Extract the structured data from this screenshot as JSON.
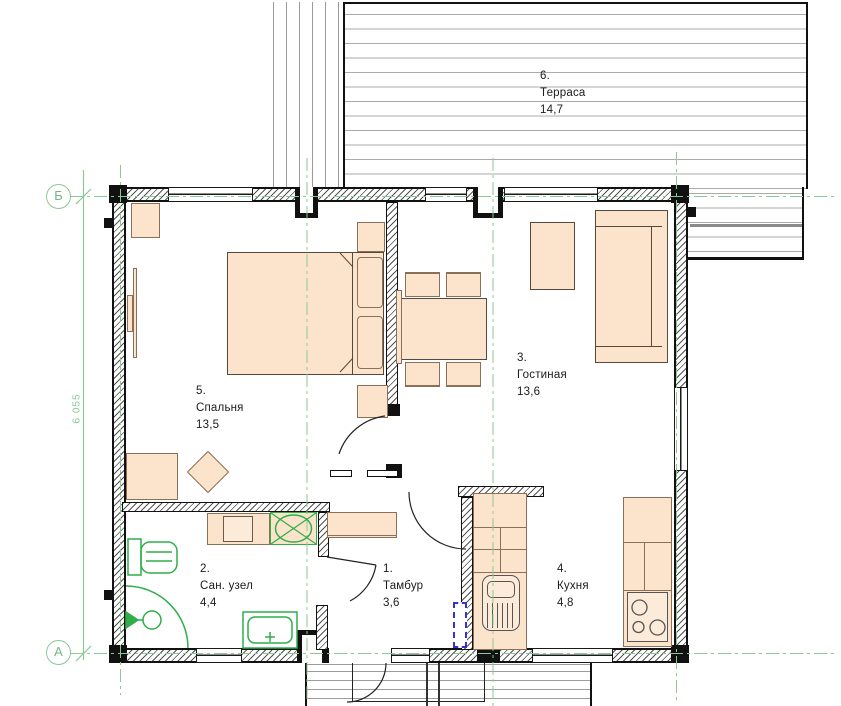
{
  "plan": {
    "title": "floor plan",
    "rooms": [
      {
        "number": "1.",
        "name": "Тамбур",
        "area": "3,6"
      },
      {
        "number": "2.",
        "name": "Сан. узел",
        "area": "4,4"
      },
      {
        "number": "3.",
        "name": "Гостиная",
        "area": "13,6"
      },
      {
        "number": "4.",
        "name": "Кухня",
        "area": "4,8"
      },
      {
        "number": "5.",
        "name": "Спальня",
        "area": "13,5"
      },
      {
        "number": "6.",
        "name": "Терраса",
        "area": "14,7"
      }
    ],
    "axis_markers": [
      {
        "label": "Б"
      },
      {
        "label": "А"
      }
    ],
    "dimensions": [
      {
        "value": "6 055"
      }
    ],
    "colors": {
      "wall": "#111111",
      "furniture_fill": "#fbe3cc",
      "furniture_stroke": "#8a7058",
      "plumbing_green": "#2fae4a",
      "axis_green": "#8cc795",
      "electric_blue": "#3535cd",
      "deck_line": "#a8a8a8",
      "text": "#1b1b1b"
    }
  }
}
